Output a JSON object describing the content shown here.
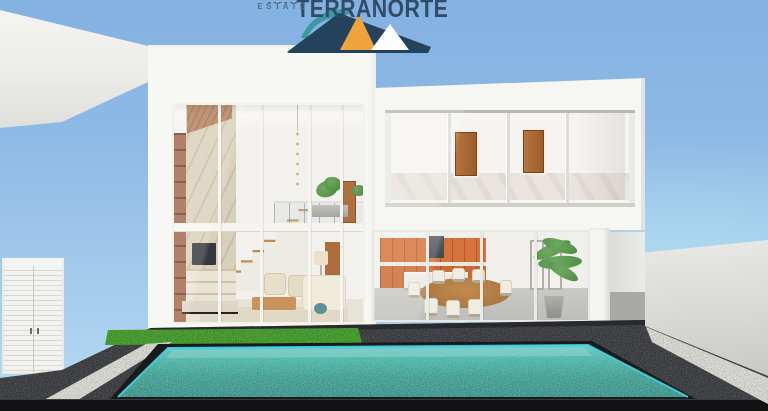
{
  "page": {
    "title": "Terranorte Real Estate — modern villa 3D render"
  },
  "logo": {
    "brand": "TERRANORTE",
    "tagline": "REAL ESTATE",
    "colors": {
      "navy": "#24425c",
      "teal": "#3f97a4",
      "orange": "#f0a23d",
      "white": "#ffffff",
      "brand_text": "#2e4d68",
      "tagline_text": "#50708c"
    }
  },
  "scene": {
    "description": "3D architectural rendering of a modern two-storey white villa: double-height glazed living room with staircase and marble TV wall, two upper bedrooms behind sliding glass with wooden doors, open kitchen with orange cabinetry and dining table, dark stone sun deck with a lawn strip, white gravel walkways and a turquoise swimming pool, framed by a white service wall with louvered gate on the left and a grey boundary wall on the right under a clear blue sky.",
    "palette": {
      "sky_top": "#83b1e1",
      "sky_horizon": "#b6dcf2",
      "house_white": "#f7f7f4",
      "glass": "#eceeec",
      "marble": "#d9d0bb",
      "wood_door": "#ad6c3c",
      "kitchen_orange": "#d6733c",
      "deck_charcoal": "#323438",
      "grass_green": "#53ae38",
      "gravel_white": "#ecece7",
      "pool_light": "#55cfd2",
      "pool_deep": "#278f85",
      "pool_rim": "#41d4e4",
      "wall_left": "#f2f2ef",
      "wall_right": "#d6d6d3",
      "shadow_black": "#121214"
    }
  }
}
